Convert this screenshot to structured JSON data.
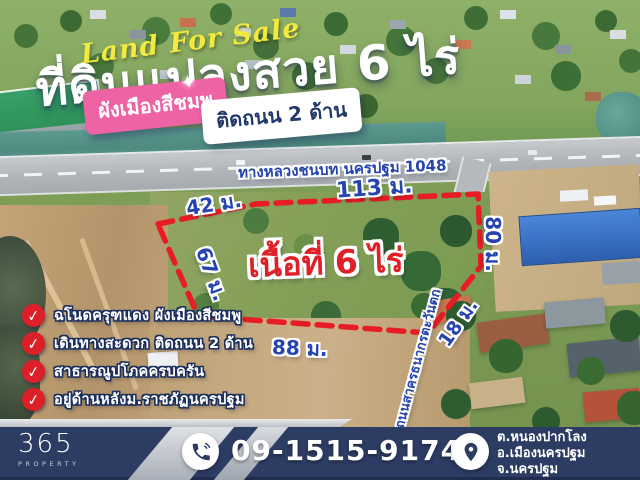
{
  "title": {
    "script": "Land For Sale",
    "headline": "ที่ดินแปลงสวย 6 ไร่"
  },
  "badges": {
    "pink": "ผังเมืองสีชมพู",
    "white": "ติดถนน 2 ด้าน"
  },
  "plot": {
    "area_label": "เนื้อที่ 6 ไร่",
    "highway_label": "ทางหลวงชนบท นครปฐม 1048",
    "side_road_label": "ถนนสาครธนากรตะวันตก",
    "measurements": [
      {
        "side": "top-left",
        "label": "42 ม."
      },
      {
        "side": "top-right",
        "label": "113 ม."
      },
      {
        "side": "left",
        "label": "67 ม."
      },
      {
        "side": "right",
        "label": "80 ม."
      },
      {
        "side": "lower-right",
        "label": "18 ม."
      },
      {
        "side": "bottom",
        "label": "88 ม."
      }
    ]
  },
  "features": [
    {
      "text": "ฉโนดครุฑแดง ผังเมืองสีชมพู"
    },
    {
      "text": "เดินทางสะดวก ติดถนน 2 ด้าน"
    },
    {
      "text": "สาธารณูปโภคครบครัน"
    },
    {
      "text": "อยู่ด้านหลังม.ราชภัฏนครปฐม"
    }
  ],
  "footer": {
    "brand_number": "365",
    "brand_name": "PROPERTY",
    "phone": "09-1515-9174",
    "address": [
      "ต.หนองปากโลง",
      "อ.เมืองนครปฐม",
      "จ.นครปฐม"
    ]
  },
  "icons": {
    "check": "✓",
    "sparkle": "✦"
  },
  "colors": {
    "accent_pink": "#ee63a4",
    "boundary_red": "#e81c24",
    "measure_blue": "#2544b0",
    "area_red": "#e02028",
    "bar_navy": "#2c3c63",
    "script_yellow": "#f2ea3e"
  }
}
